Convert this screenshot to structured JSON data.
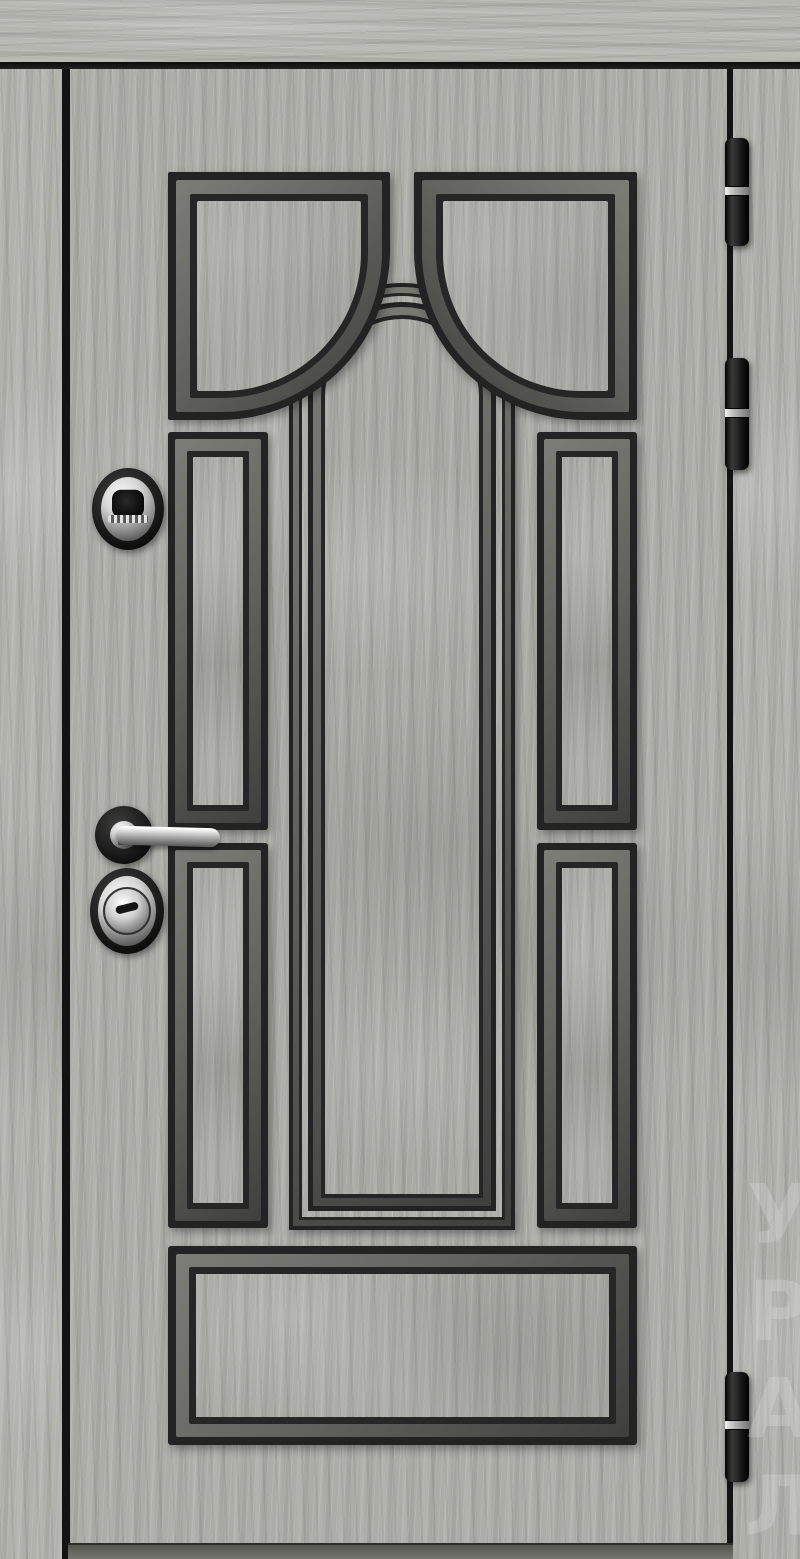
{
  "scene": {
    "type": "product-photo",
    "subject": "Closed steel entrance door, front view, light grey wood-grain laminate with black classic arched panel moldings",
    "orientation": "right-hinged (three barrel hinges on the right edge)"
  },
  "frame": {
    "finish": "light grey wood-grain casing",
    "casing_color": "#b4b4af",
    "gap_color": "#141414",
    "threshold_color": "#6f6f6b"
  },
  "door": {
    "finish_color": "#adada8",
    "molding_color": "#232323",
    "bevel_color": "#636360",
    "design": "central arched window motif",
    "panels": {
      "top_panels": 2,
      "upper_side_panels": 2,
      "lower_side_panels": 2,
      "bottom_panel": 1,
      "arch_bands": 2
    }
  },
  "hardware": {
    "peephole": "oval chrome security escutcheon with dark lens",
    "handle": "chrome lever handle on round black rosette",
    "cylinder": "oval black escutcheon with chrome key cylinder",
    "chrome_color": "#d6d6d6",
    "hinge_count": 3,
    "hinge_color": "#1c1c1c"
  },
  "watermark": {
    "text": "УРАЛ",
    "color": "#ffffff",
    "opacity": 0.17,
    "position": "lower right edge, vertical, partially cropped"
  }
}
